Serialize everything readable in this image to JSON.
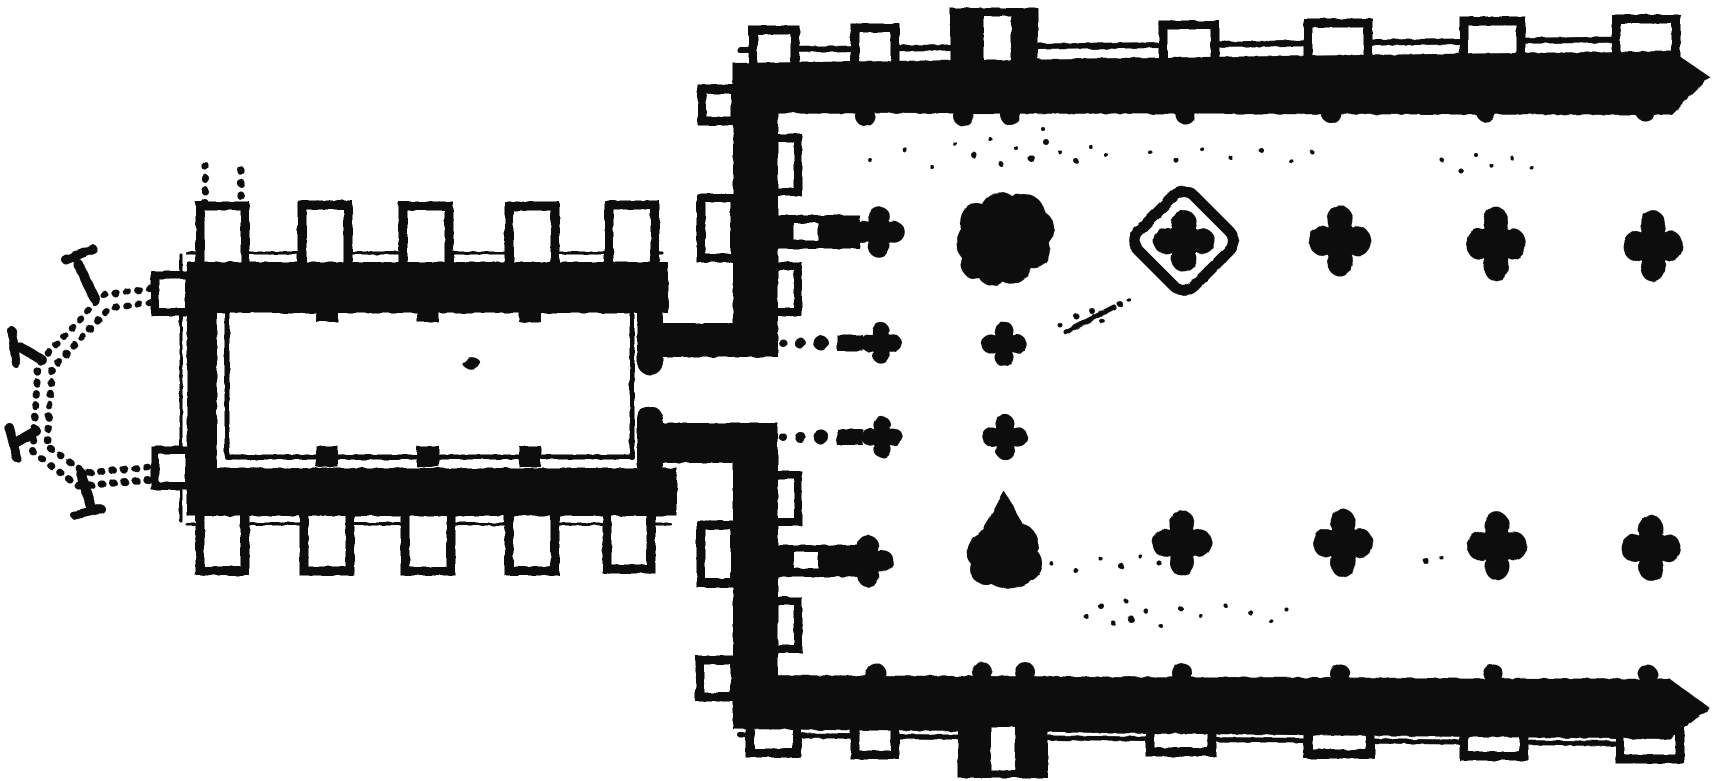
{
  "figure": {
    "width": 1719,
    "height": 781,
    "background": "#ffffff",
    "ink": "#101010",
    "kind": "engraved-church-floor-plan"
  },
  "shapes": {
    "blob1": "M -45,-12 C -50,-28 -38,-42 -24,-37 C -18,-49 -4,-53 6,-45 C 20,-52 37,-44 39,-29 C 50,-22 51,-6 43,2 C 48,16 38,29 25,27 C 22,40 8,47 -3,41 C -9,48 -22,46 -27,37 C -39,40 -48,30 -44,17 C -51,9 -51,-3 -45,-12 Z",
    "blob2": "M -2,-49 C 5,-39 10,-28 16,-17 C 28,-13 36,-1 31,11 C 40,19 38,35 25,41 C 15,49 -3,51 -15,44 C -29,47 -39,36 -35,24 C -43,14 -39,-1 -28,-6 C -19,-14 -10,-35 -2,-49 Z"
  },
  "plan": {
    "apse": [
      {
        "t": "path",
        "d": "M162,287 L103,295 L38,364 L33,452 L78,486 L162,479",
        "sw": 7,
        "fill": "none",
        "dash": "1.5 10"
      },
      {
        "t": "path",
        "d": "M162,301 L110,308 L52,369 L47,446 L85,473 L162,466",
        "sw": 7,
        "fill": "none",
        "dash": "1.5 10"
      },
      {
        "t": "path",
        "d": "M95,299 L78,264",
        "sw": 10
      },
      {
        "t": "path",
        "d": "M66,260 L93,249",
        "sw": 9
      },
      {
        "t": "path",
        "d": "M42,360 L20,347",
        "sw": 10
      },
      {
        "t": "path",
        "d": "M12,331 L16,363",
        "sw": 9
      },
      {
        "t": "path",
        "d": "M36,431 L15,443",
        "sw": 10
      },
      {
        "t": "path",
        "d": "M9,427 L17,458",
        "sw": 9
      },
      {
        "t": "path",
        "d": "M81,473 L91,507",
        "sw": 10
      },
      {
        "t": "path",
        "d": "M75,515 L101,509",
        "sw": 9
      }
    ],
    "chancel": [
      {
        "t": "path",
        "d": "M205,165 L205,212",
        "sw": 7,
        "fill": "none",
        "dash": "1.5 11"
      },
      {
        "t": "path",
        "d": "M241,170 L241,214",
        "sw": 7,
        "fill": "none",
        "dash": "1.5 11"
      },
      {
        "t": "path",
        "d": "M205,518 L205,566",
        "sw": 7,
        "fill": "none",
        "dash": "1.5 11"
      },
      {
        "t": "path",
        "d": "M241,522 L241,570",
        "sw": 7,
        "fill": "none",
        "dash": "1.5 11"
      },
      {
        "t": "path",
        "d": "M187,253 L662,253",
        "sw": 3
      },
      {
        "t": "path",
        "d": "M187,524 L670,524",
        "sw": 3
      },
      {
        "t": "path",
        "d": "M181,255 L181,521",
        "sw": 3
      },
      {
        "t": "box",
        "x": 200,
        "y": 206,
        "w": 45,
        "h": 62,
        "sw": 9
      },
      {
        "t": "box",
        "x": 302,
        "y": 205,
        "w": 46,
        "h": 62,
        "sw": 9
      },
      {
        "t": "box",
        "x": 403,
        "y": 206,
        "w": 46,
        "h": 61,
        "sw": 9
      },
      {
        "t": "box",
        "x": 509,
        "y": 206,
        "w": 46,
        "h": 61,
        "sw": 9
      },
      {
        "t": "box",
        "x": 609,
        "y": 205,
        "w": 46,
        "h": 62,
        "sw": 9
      },
      {
        "t": "box",
        "x": 200,
        "y": 511,
        "w": 45,
        "h": 60,
        "sw": 9
      },
      {
        "t": "box",
        "x": 304,
        "y": 511,
        "w": 46,
        "h": 60,
        "sw": 9
      },
      {
        "t": "box",
        "x": 405,
        "y": 511,
        "w": 46,
        "h": 60,
        "sw": 9
      },
      {
        "t": "box",
        "x": 509,
        "y": 511,
        "w": 46,
        "h": 60,
        "sw": 9
      },
      {
        "t": "box",
        "x": 607,
        "y": 509,
        "w": 44,
        "h": 60,
        "sw": 9
      },
      {
        "t": "box",
        "x": 155,
        "y": 275,
        "w": 34,
        "h": 37,
        "sw": 8
      },
      {
        "t": "box",
        "x": 155,
        "y": 450,
        "w": 34,
        "h": 36,
        "sw": 8
      },
      {
        "t": "rect",
        "x": 187,
        "y": 262,
        "w": 481,
        "h": 51
      },
      {
        "t": "rect",
        "x": 187,
        "y": 468,
        "w": 490,
        "h": 48
      },
      {
        "t": "rect",
        "x": 187,
        "y": 262,
        "w": 30,
        "h": 254
      },
      {
        "t": "path",
        "d": "M227,310 L632,310 L632,457 L227,457 Z",
        "sw": 5,
        "fill": "none"
      },
      {
        "t": "rect",
        "x": 316,
        "y": 301,
        "w": 22,
        "h": 21
      },
      {
        "t": "rect",
        "x": 417,
        "y": 301,
        "w": 22,
        "h": 21
      },
      {
        "t": "rect",
        "x": 519,
        "y": 301,
        "w": 22,
        "h": 21
      },
      {
        "t": "rect",
        "x": 316,
        "y": 446,
        "w": 22,
        "h": 21
      },
      {
        "t": "rect",
        "x": 417,
        "y": 446,
        "w": 22,
        "h": 21
      },
      {
        "t": "rect",
        "x": 519,
        "y": 446,
        "w": 22,
        "h": 21
      },
      {
        "t": "path",
        "d": "M464,362 q4,-7 12,-4 q7,3 2,9 q-6,5 -12,1 q-5,-3 -2,-6 Z",
        "fill": "ink",
        "sw": 0
      }
    ],
    "junction": [
      {
        "t": "rect",
        "x": 637,
        "y": 313,
        "w": 26,
        "h": 50
      },
      {
        "t": "circle",
        "cx": 650,
        "cy": 362,
        "r": 13
      },
      {
        "t": "rect",
        "x": 663,
        "y": 323,
        "w": 112,
        "h": 34
      },
      {
        "t": "rect",
        "x": 637,
        "y": 418,
        "w": 26,
        "h": 50
      },
      {
        "t": "circle",
        "cx": 650,
        "cy": 419,
        "r": 13
      },
      {
        "t": "rect",
        "x": 663,
        "y": 423,
        "w": 112,
        "h": 40
      }
    ],
    "west_wall": [
      {
        "t": "box",
        "x": 702,
        "y": 89,
        "w": 33,
        "h": 32,
        "sw": 9
      },
      {
        "t": "box",
        "x": 701,
        "y": 198,
        "w": 34,
        "h": 60,
        "sw": 9
      },
      {
        "t": "box",
        "x": 701,
        "y": 525,
        "w": 34,
        "h": 58,
        "sw": 9
      },
      {
        "t": "box",
        "x": 700,
        "y": 660,
        "w": 35,
        "h": 37,
        "sw": 9
      },
      {
        "t": "box",
        "x": 774,
        "y": 138,
        "w": 24,
        "h": 54,
        "sw": 8
      },
      {
        "t": "box",
        "x": 774,
        "y": 266,
        "w": 24,
        "h": 46,
        "sw": 8
      },
      {
        "t": "box",
        "x": 774,
        "y": 475,
        "w": 24,
        "h": 47,
        "sw": 8
      },
      {
        "t": "box",
        "x": 774,
        "y": 601,
        "w": 24,
        "h": 48,
        "sw": 8
      },
      {
        "t": "rect",
        "x": 733,
        "y": 63,
        "w": 45,
        "h": 294
      },
      {
        "t": "rect",
        "x": 733,
        "y": 423,
        "w": 45,
        "h": 304
      },
      {
        "t": "rect",
        "x": 778,
        "y": 215,
        "w": 82,
        "h": 34
      },
      {
        "t": "white",
        "x": 794,
        "y": 223,
        "w": 24,
        "h": 17
      },
      {
        "t": "quat",
        "cx": 879,
        "cy": 232,
        "s": 25,
        "sy": 1
      },
      {
        "t": "rect",
        "x": 778,
        "y": 545,
        "w": 80,
        "h": 32
      },
      {
        "t": "white",
        "x": 794,
        "y": 552,
        "w": 24,
        "h": 16
      },
      {
        "t": "quat",
        "cx": 868,
        "cy": 561,
        "s": 25,
        "sy": 1
      },
      {
        "t": "circle",
        "cx": 783,
        "cy": 343,
        "r": 4
      },
      {
        "t": "circle",
        "cx": 800,
        "cy": 343,
        "r": 5.5
      },
      {
        "t": "circle",
        "cx": 821,
        "cy": 343,
        "r": 7.5
      },
      {
        "t": "rect",
        "x": 837,
        "y": 335,
        "w": 26,
        "h": 16
      },
      {
        "t": "quat",
        "cx": 881,
        "cy": 343,
        "s": 20,
        "sy": 1
      },
      {
        "t": "circle",
        "cx": 783,
        "cy": 437,
        "r": 4
      },
      {
        "t": "circle",
        "cx": 800,
        "cy": 437,
        "r": 5.5
      },
      {
        "t": "circle",
        "cx": 821,
        "cy": 437,
        "r": 7.5
      },
      {
        "t": "rect",
        "x": 837,
        "y": 429,
        "w": 26,
        "h": 16
      },
      {
        "t": "quat",
        "cx": 882,
        "cy": 437,
        "s": 20,
        "sy": 1
      }
    ],
    "north_wall": [
      {
        "t": "path",
        "d": "M740,50 L1672,39",
        "sw": 6
      },
      {
        "t": "box",
        "x": 753,
        "y": 30,
        "w": 42,
        "h": 38,
        "sw": 9
      },
      {
        "t": "box",
        "x": 855,
        "y": 28,
        "w": 40,
        "h": 38,
        "sw": 9
      },
      {
        "t": "box",
        "x": 1163,
        "y": 25,
        "w": 52,
        "h": 38,
        "sw": 9
      },
      {
        "t": "box",
        "x": 1308,
        "y": 23,
        "w": 60,
        "h": 38,
        "sw": 9
      },
      {
        "t": "box",
        "x": 1464,
        "y": 21,
        "w": 57,
        "h": 38,
        "sw": 9
      },
      {
        "t": "box",
        "x": 1616,
        "y": 19,
        "w": 60,
        "h": 38,
        "sw": 9
      },
      {
        "t": "poly",
        "pts": "733,63 1672,51 1710,77 1672,115 733,113"
      },
      {
        "t": "rect",
        "x": 950,
        "y": 8,
        "w": 88,
        "h": 56
      },
      {
        "t": "white",
        "x": 984,
        "y": 16,
        "w": 27,
        "h": 44
      },
      {
        "t": "circle",
        "cx": 865,
        "cy": 116,
        "r": 10
      },
      {
        "t": "circle",
        "cx": 963,
        "cy": 116,
        "r": 10
      },
      {
        "t": "circle",
        "cx": 1010,
        "cy": 115,
        "r": 10
      },
      {
        "t": "circle",
        "cx": 1185,
        "cy": 114,
        "r": 10
      },
      {
        "t": "circle",
        "cx": 1331,
        "cy": 113,
        "r": 10
      },
      {
        "t": "circle",
        "cx": 1486,
        "cy": 112,
        "r": 10
      },
      {
        "t": "circle",
        "cx": 1645,
        "cy": 111,
        "r": 10
      }
    ],
    "south_wall": [
      {
        "t": "path",
        "d": "M740,735 L1664,744",
        "sw": 5
      },
      {
        "t": "box",
        "x": 750,
        "y": 715,
        "w": 47,
        "h": 38,
        "sw": 9
      },
      {
        "t": "box",
        "x": 855,
        "y": 717,
        "w": 40,
        "h": 38,
        "sw": 9
      },
      {
        "t": "box",
        "x": 1150,
        "y": 724,
        "w": 62,
        "h": 28,
        "sw": 9
      },
      {
        "t": "box",
        "x": 1308,
        "y": 726,
        "w": 62,
        "h": 28,
        "sw": 9
      },
      {
        "t": "box",
        "x": 1464,
        "y": 728,
        "w": 60,
        "h": 28,
        "sw": 9
      },
      {
        "t": "box",
        "x": 1620,
        "y": 731,
        "w": 60,
        "h": 28,
        "sw": 9
      },
      {
        "t": "poly",
        "pts": "733,675 1670,679 1710,708 1670,739 733,729"
      },
      {
        "t": "rect",
        "x": 958,
        "y": 722,
        "w": 90,
        "h": 56
      },
      {
        "t": "white",
        "x": 991,
        "y": 727,
        "w": 24,
        "h": 43
      },
      {
        "t": "circle",
        "cx": 876,
        "cy": 673,
        "r": 10
      },
      {
        "t": "circle",
        "cx": 982,
        "cy": 672,
        "r": 10
      },
      {
        "t": "circle",
        "cx": 1025,
        "cy": 672,
        "r": 10
      },
      {
        "t": "circle",
        "cx": 1182,
        "cy": 673,
        "r": 10
      },
      {
        "t": "circle",
        "cx": 1340,
        "cy": 674,
        "r": 10
      },
      {
        "t": "circle",
        "cx": 1493,
        "cy": 674,
        "r": 10
      },
      {
        "t": "circle",
        "cx": 1648,
        "cy": 675,
        "r": 10
      }
    ],
    "piers": [
      {
        "t": "blob",
        "cx": 1006,
        "cy": 241,
        "ref": "blob1"
      },
      {
        "t": "loz",
        "cx": 1184,
        "cy": 241,
        "side": 78,
        "rx": 14,
        "sw": 11
      },
      {
        "t": "quat",
        "cx": 1184,
        "cy": 241,
        "s": 30,
        "sy": 1
      },
      {
        "t": "quat",
        "cx": 1340,
        "cy": 241,
        "s": 30,
        "sy": 1.15
      },
      {
        "t": "quat",
        "cx": 1496,
        "cy": 244,
        "s": 29,
        "sy": 1.25
      },
      {
        "t": "quat",
        "cx": 1653,
        "cy": 246,
        "s": 29,
        "sy": 1.2
      },
      {
        "t": "quat",
        "cx": 1004,
        "cy": 344,
        "s": 22,
        "sy": 1
      },
      {
        "t": "quat",
        "cx": 1005,
        "cy": 437,
        "s": 22,
        "sy": 1
      },
      {
        "t": "blob",
        "cx": 1006,
        "cy": 540,
        "ref": "blob2"
      },
      {
        "t": "quat",
        "cx": 1182,
        "cy": 543,
        "s": 29,
        "sy": 1.1
      },
      {
        "t": "quat",
        "cx": 1343,
        "cy": 543,
        "s": 29,
        "sy": 1.15
      },
      {
        "t": "quat",
        "cx": 1497,
        "cy": 546,
        "s": 29,
        "sy": 1.15
      },
      {
        "t": "quat",
        "cx": 1651,
        "cy": 548,
        "s": 29,
        "sy": 1.1
      }
    ],
    "noise": [
      {
        "t": "path",
        "d": "M1066,332 L1114,307",
        "sw": 5
      },
      {
        "t": "circle",
        "cx": 1076,
        "cy": 316,
        "r": 3
      },
      {
        "t": "circle",
        "cx": 1092,
        "cy": 311,
        "r": 3
      },
      {
        "t": "circle",
        "cx": 1102,
        "cy": 321,
        "r": 2.5
      },
      {
        "t": "circle",
        "cx": 1120,
        "cy": 304,
        "r": 3
      },
      {
        "t": "circle",
        "cx": 1129,
        "cy": 300,
        "r": 2.2
      },
      {
        "t": "circle",
        "cx": 1060,
        "cy": 325,
        "r": 2.5
      },
      {
        "t": "circle",
        "cx": 870,
        "cy": 160,
        "r": 2
      },
      {
        "t": "circle",
        "cx": 905,
        "cy": 150,
        "r": 2.5
      },
      {
        "t": "circle",
        "cx": 932,
        "cy": 167,
        "r": 2
      },
      {
        "t": "circle",
        "cx": 955,
        "cy": 144,
        "r": 2
      },
      {
        "t": "circle",
        "cx": 974,
        "cy": 155,
        "r": 3
      },
      {
        "t": "circle",
        "cx": 990,
        "cy": 139,
        "r": 2
      },
      {
        "t": "circle",
        "cx": 1001,
        "cy": 164,
        "r": 2.5
      },
      {
        "t": "circle",
        "cx": 1016,
        "cy": 148,
        "r": 2
      },
      {
        "t": "circle",
        "cx": 1031,
        "cy": 158,
        "r": 3.5
      },
      {
        "t": "circle",
        "cx": 1046,
        "cy": 142,
        "r": 3
      },
      {
        "t": "circle",
        "cx": 1060,
        "cy": 152,
        "r": 2
      },
      {
        "t": "circle",
        "cx": 1076,
        "cy": 161,
        "r": 2.5
      },
      {
        "t": "circle",
        "cx": 1091,
        "cy": 147,
        "r": 2
      },
      {
        "t": "circle",
        "cx": 1106,
        "cy": 155,
        "r": 2
      },
      {
        "t": "circle",
        "cx": 1043,
        "cy": 129,
        "r": 2
      },
      {
        "t": "circle",
        "cx": 1150,
        "cy": 152,
        "r": 2
      },
      {
        "t": "circle",
        "cx": 1176,
        "cy": 160,
        "r": 2.5
      },
      {
        "t": "circle",
        "cx": 1202,
        "cy": 149,
        "r": 2
      },
      {
        "t": "circle",
        "cx": 1231,
        "cy": 158,
        "r": 2
      },
      {
        "t": "circle",
        "cx": 1261,
        "cy": 150,
        "r": 2.5
      },
      {
        "t": "circle",
        "cx": 1291,
        "cy": 161,
        "r": 2
      },
      {
        "t": "circle",
        "cx": 1312,
        "cy": 152,
        "r": 2
      },
      {
        "t": "circle",
        "cx": 1442,
        "cy": 160,
        "r": 2
      },
      {
        "t": "circle",
        "cx": 1461,
        "cy": 171,
        "r": 2.5
      },
      {
        "t": "circle",
        "cx": 1476,
        "cy": 155,
        "r": 2
      },
      {
        "t": "circle",
        "cx": 1492,
        "cy": 166,
        "r": 2
      },
      {
        "t": "circle",
        "cx": 1512,
        "cy": 158,
        "r": 2
      },
      {
        "t": "circle",
        "cx": 1532,
        "cy": 168,
        "r": 2
      },
      {
        "t": "circle",
        "cx": 987,
        "cy": 561,
        "r": 2.5
      },
      {
        "t": "circle",
        "cx": 1006,
        "cy": 568,
        "r": 2
      },
      {
        "t": "circle",
        "cx": 1026,
        "cy": 556,
        "r": 3
      },
      {
        "t": "circle",
        "cx": 1051,
        "cy": 563,
        "r": 2
      },
      {
        "t": "circle",
        "cx": 1076,
        "cy": 571,
        "r": 2.5
      },
      {
        "t": "circle",
        "cx": 1101,
        "cy": 559,
        "r": 2
      },
      {
        "t": "circle",
        "cx": 1121,
        "cy": 566,
        "r": 3
      },
      {
        "t": "circle",
        "cx": 1141,
        "cy": 557,
        "r": 2
      },
      {
        "t": "circle",
        "cx": 1159,
        "cy": 563,
        "r": 2.5
      },
      {
        "t": "circle",
        "cx": 1426,
        "cy": 561,
        "r": 3
      },
      {
        "t": "circle",
        "cx": 1441,
        "cy": 557,
        "r": 2
      },
      {
        "t": "circle",
        "cx": 1086,
        "cy": 616,
        "r": 2.5
      },
      {
        "t": "circle",
        "cx": 1101,
        "cy": 606,
        "r": 3
      },
      {
        "t": "circle",
        "cx": 1113,
        "cy": 623,
        "r": 2.5
      },
      {
        "t": "circle",
        "cx": 1126,
        "cy": 601,
        "r": 2
      },
      {
        "t": "circle",
        "cx": 1131,
        "cy": 619,
        "r": 3.5
      },
      {
        "t": "circle",
        "cx": 1146,
        "cy": 611,
        "r": 2.5
      },
      {
        "t": "circle",
        "cx": 1161,
        "cy": 626,
        "r": 2
      },
      {
        "t": "circle",
        "cx": 1181,
        "cy": 609,
        "r": 2.5
      },
      {
        "t": "circle",
        "cx": 1201,
        "cy": 616,
        "r": 2
      },
      {
        "t": "circle",
        "cx": 1226,
        "cy": 606,
        "r": 2
      },
      {
        "t": "circle",
        "cx": 1251,
        "cy": 613,
        "r": 2.5
      },
      {
        "t": "circle",
        "cx": 1271,
        "cy": 621,
        "r": 2
      },
      {
        "t": "circle",
        "cx": 1286,
        "cy": 609,
        "r": 2
      }
    ]
  }
}
